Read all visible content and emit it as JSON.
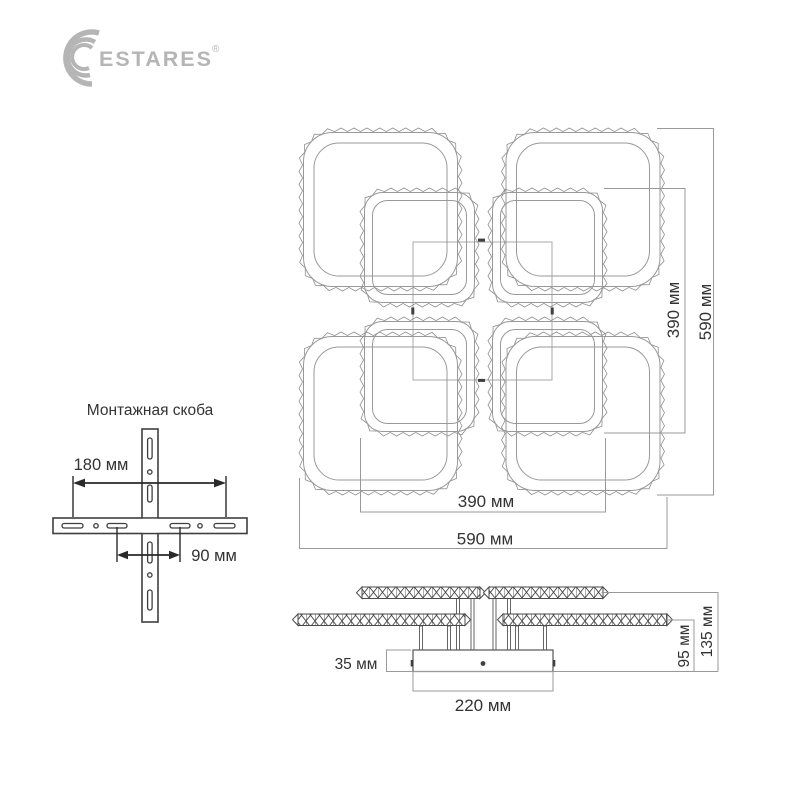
{
  "brand": {
    "name": "ESTARES",
    "registered_mark": "®",
    "logo_color": "#b5b5b5"
  },
  "mounting_bracket": {
    "title": "Монтажная скоба",
    "dim_outer_span": "180 мм",
    "dim_inner_span": "90 мм"
  },
  "top_view": {
    "dim_rings_height": "390 мм",
    "dim_overall_height": "590 мм",
    "dim_rings_width": "390 мм",
    "dim_overall_width": "590 мм"
  },
  "side_view": {
    "dim_base_height": "35 мм",
    "dim_base_width": "220 мм",
    "dim_rings_level": "95 мм",
    "dim_overall_height": "135 мм"
  },
  "colors": {
    "background": "#ffffff",
    "ring_line": "#8f8f8f",
    "dim_line": "#999999",
    "dark_line": "#3f3f3f",
    "text": "#333333",
    "logo": "#b5b5b5"
  }
}
